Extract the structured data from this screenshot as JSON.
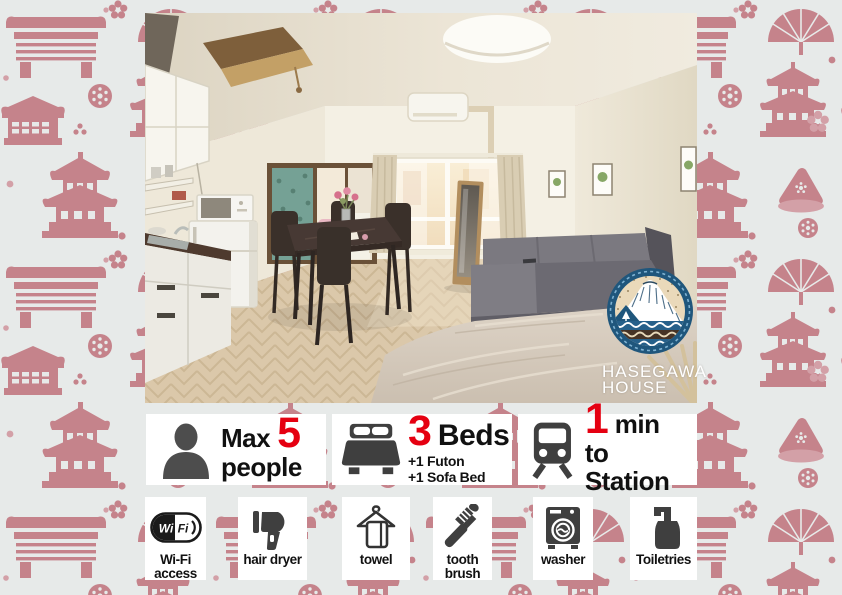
{
  "colors": {
    "background": "#e7eae9",
    "pattern_pink": "#c5838b",
    "pattern_pink_light": "#d3a0a7",
    "accent_red": "#e50011",
    "icon_gray": "#3f3f3f",
    "logo_blue": "#1f567c",
    "logo_sand": "#ead9ba",
    "logo_brown": "#463325",
    "card_white": "#ffffff"
  },
  "logo": {
    "line1": "HASEGAWA",
    "line2": "HOUSE"
  },
  "capacity_badge": {
    "icon": "person-icon",
    "prefix": "Max",
    "number": "5",
    "unit": "people"
  },
  "beds_badge": {
    "icon": "bed-icon",
    "number": "3",
    "unit": "Beds",
    "extra1": "+1 Futon",
    "extra2": "+1 Sofa Bed"
  },
  "station_badge": {
    "icon": "train-icon",
    "number": "1",
    "unit": "min",
    "line2": "to Station"
  },
  "amenities": [
    {
      "icon": "wifi-icon",
      "logo_left": "Wi",
      "logo_right": "Fi",
      "line1": "Wi-Fi",
      "line2": "access"
    },
    {
      "icon": "hair-dryer-icon",
      "line1": "hair dryer"
    },
    {
      "icon": "towel-icon",
      "line1": "towel"
    },
    {
      "icon": "toothbrush-icon",
      "line1": "tooth",
      "line2": "brush"
    },
    {
      "icon": "washer-icon",
      "line1": "washer"
    },
    {
      "icon": "toiletries-icon",
      "line1": "Toiletries"
    }
  ],
  "photo": {
    "subject": "studio apartment interior with kitchen, dining table, sofa and bed"
  }
}
